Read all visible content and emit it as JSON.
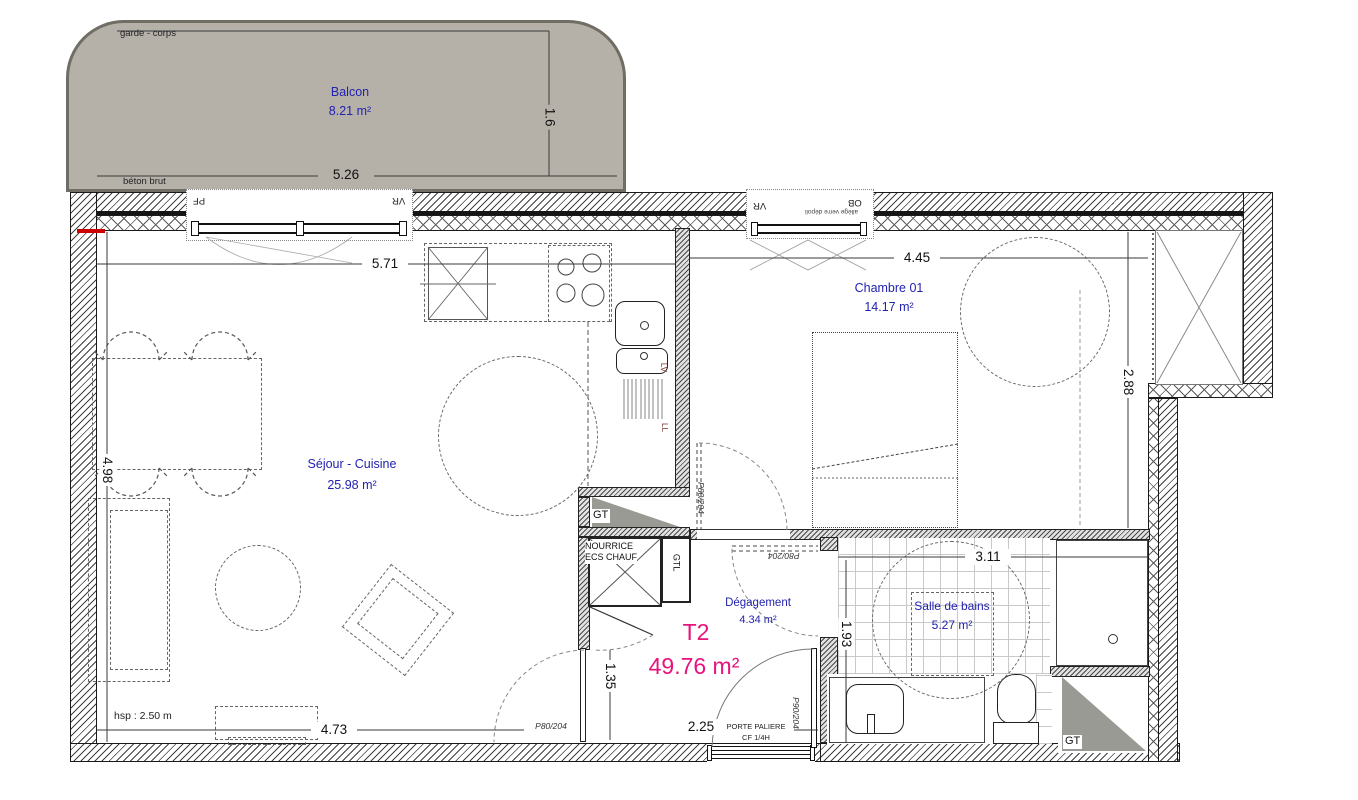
{
  "rooms": {
    "balcony": {
      "name": "Balcon",
      "area": "8.21 m²"
    },
    "living": {
      "name": "Séjour - Cuisine",
      "area": "25.98 m²"
    },
    "bedroom": {
      "name": "Chambre 01",
      "area": "14.17 m²"
    },
    "bathroom": {
      "name": "Salle de bains",
      "area": "5.27 m²"
    },
    "hall": {
      "name": "Dégagement",
      "area": "4.34 m²"
    }
  },
  "unit": {
    "type": "T2",
    "area": "49.76 m²"
  },
  "dims": {
    "balcony_w": "5.26",
    "balcony_d": "1.6",
    "living_w": "5.71",
    "living_h": "4.98",
    "living_w2": "4.73",
    "bedroom_w": "4.45",
    "bedroom_h": "2.88",
    "bath_w": "3.11",
    "bath_h": "1.93",
    "hall_door": "1.35",
    "entry_w": "2.25"
  },
  "doors": {
    "living": "P80/204",
    "bedroom": "P80/204",
    "bathroom": "P80/204",
    "entrance": "P90/204",
    "entrance_label1": "PORTE PALIERE",
    "entrance_label2": "CF 1/4H"
  },
  "windows": {
    "pf": "PF",
    "vr": "VR",
    "ob": "OB",
    "frosted_note": "allège verre dépoli"
  },
  "notes": {
    "guardrail": "garde - corps",
    "concrete": "béton brut",
    "ceiling_height": "hsp : 2.50 m"
  },
  "tech": {
    "gt": "GT",
    "gtl": "GTL",
    "manifold1": "NOURRICE",
    "manifold2": "ECS CHAUF",
    "dishwasher": "LV",
    "washer": "LL"
  },
  "colors": {
    "room_label": "#2222b0",
    "unit_label": "#e8127c",
    "balcony_fill": "#b5b1a9",
    "duct_gray": "#9a9a95"
  }
}
